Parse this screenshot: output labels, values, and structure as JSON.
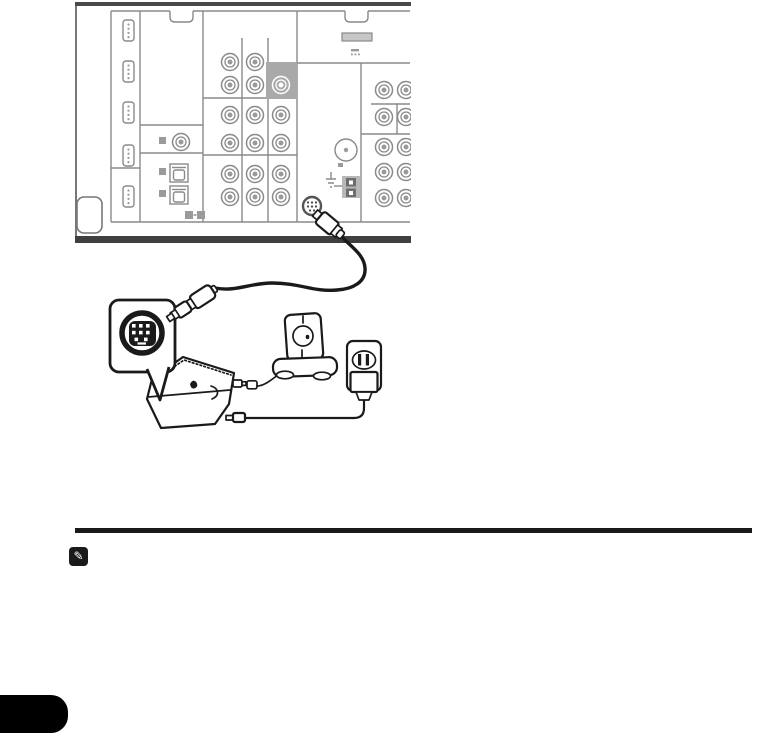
{
  "page": {
    "background": "#ffffff",
    "kind": "manual-page-connection-figure",
    "page_number_text": ""
  },
  "note_section": {
    "icon": "pencil-note-icon",
    "icon_glyph": "✎",
    "rule_color": "#1a1a1a"
  },
  "figure": {
    "description": "Rear panel of AV receiver with cable from its round mini-DIN adapter port running to a satellite tuner box, a detail callout of the 8-pin mini-DIN connector face, an antenna unit on a stand, and an AC adapter plugged into a wall outlet",
    "colors": {
      "ink": "#1a1a1a",
      "line": "#8a8a8a",
      "chassis": "#4a4a4a",
      "chassis2": "#3f3f3f",
      "edge": "#777777",
      "highlight": "#a9a9a9",
      "fillgray": "#c6c6c6",
      "labelgray": "#9a9a9a",
      "termgray": "#b8b8b8",
      "termdark": "#6e6e6e"
    },
    "receiver": {
      "name": "av-receiver-rear-panel",
      "hdmi_ports": [
        [
          123,
          20
        ],
        [
          123,
          61
        ],
        [
          123,
          102
        ],
        [
          123,
          145
        ],
        [
          123,
          186
        ]
      ],
      "optical_ports": [
        [
          170,
          164
        ],
        [
          170,
          186
        ]
      ],
      "label_squares": [
        [
          159,
          137,
          7
        ],
        [
          159,
          168,
          7
        ],
        [
          159,
          190,
          7
        ],
        [
          185,
          211,
          8
        ],
        [
          197,
          211,
          8
        ]
      ],
      "rca_jacks": [
        [
          230,
          62,
          0
        ],
        [
          255,
          62,
          0
        ],
        [
          230,
          85,
          0
        ],
        [
          255,
          85,
          0
        ],
        [
          281,
          85,
          1
        ],
        [
          230,
          115,
          0
        ],
        [
          255,
          115,
          0
        ],
        [
          281,
          115,
          0
        ],
        [
          230,
          143,
          0
        ],
        [
          255,
          143,
          0
        ],
        [
          281,
          143,
          0
        ],
        [
          230,
          174,
          0
        ],
        [
          255,
          174,
          0
        ],
        [
          281,
          174,
          0
        ],
        [
          230,
          197,
          0
        ],
        [
          255,
          197,
          0
        ],
        [
          281,
          197,
          0
        ],
        [
          181,
          142,
          0
        ],
        [
          384,
          90,
          0
        ],
        [
          406,
          90,
          0
        ],
        [
          384,
          117,
          0
        ],
        [
          406,
          117,
          0
        ],
        [
          384,
          147,
          0
        ],
        [
          406,
          147,
          0
        ],
        [
          384,
          172,
          0
        ],
        [
          406,
          172,
          0
        ],
        [
          384,
          198,
          0
        ],
        [
          406,
          198,
          0
        ]
      ],
      "highlight_cell": [
        266,
        62,
        31,
        37
      ],
      "fm_antenna_jack": [
        346,
        150
      ],
      "adapter_port": [
        312,
        206
      ],
      "adapter_port_type": "mini-DIN"
    },
    "callout": {
      "connector_type": "8-pin mini-DIN connector face",
      "pin_count": 8
    },
    "devices": [
      {
        "id": "tuner-box",
        "label": "satellite tuner box"
      },
      {
        "id": "antenna-unit",
        "label": "antenna on stand"
      },
      {
        "id": "ac-adapter",
        "label": "AC adapter in wall outlet"
      }
    ]
  }
}
